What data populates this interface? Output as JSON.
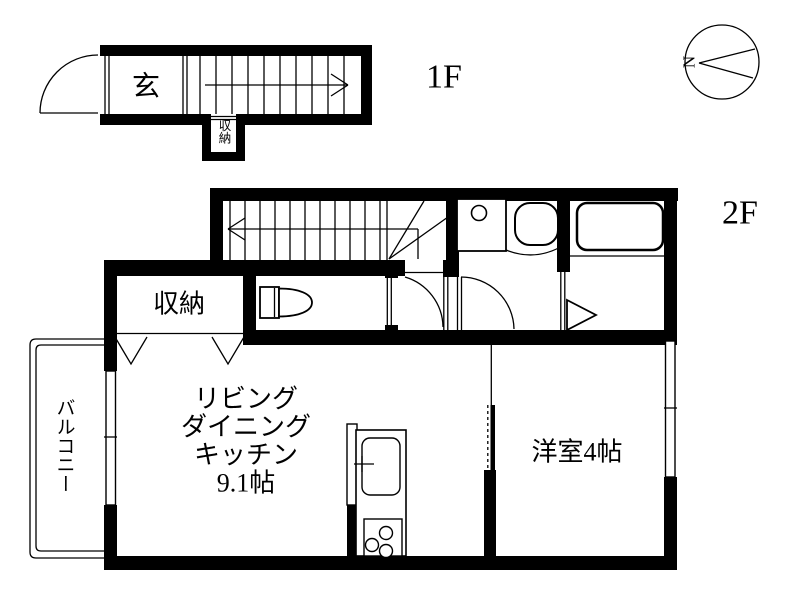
{
  "page": {
    "background": "#ffffff",
    "ink": "#000000"
  },
  "floor1": {
    "label": "1F",
    "genkan_label": "玄",
    "storage_label": "収納"
  },
  "floor2": {
    "label": "2F",
    "storage_label": "収納",
    "ldk": {
      "line1": "リビング",
      "line2": "ダイニング",
      "line3": "キッチン",
      "line4": "9.1帖"
    },
    "western_room_label": "洋室4帖",
    "balcony_label": "バルコニー"
  },
  "compass": {
    "north_label": "N"
  }
}
